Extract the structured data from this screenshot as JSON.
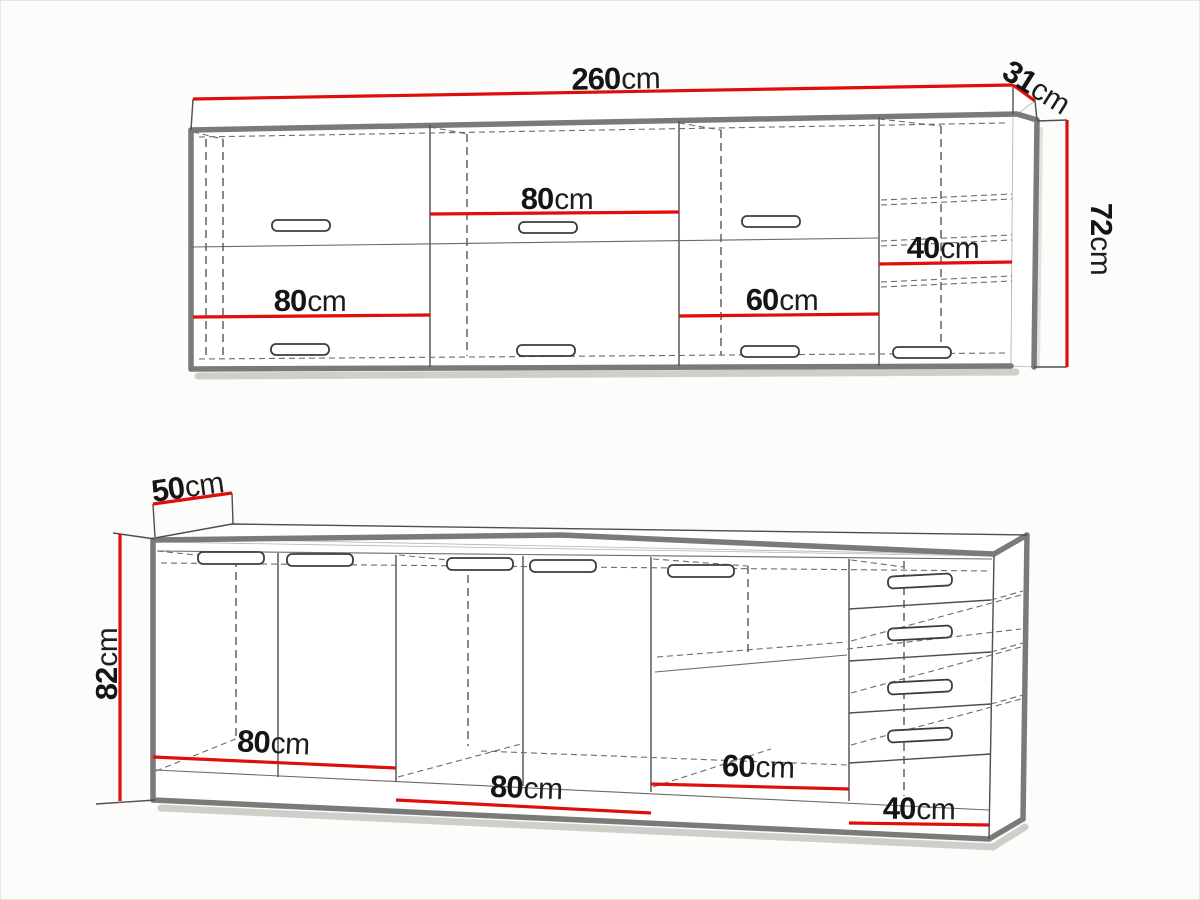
{
  "page": {
    "background": "#fcfcfa",
    "accent_red": "#e00d0d",
    "outline_gray": "#7a7a7a"
  },
  "wall_unit": {
    "name": "wall cabinet run",
    "width": {
      "value": "260",
      "unit": "cm"
    },
    "depth": {
      "value": "31",
      "unit": "cm"
    },
    "height": {
      "value": "72",
      "unit": "cm"
    },
    "sections": [
      {
        "value": "80",
        "unit": "cm"
      },
      {
        "value": "80",
        "unit": "cm"
      },
      {
        "value": "60",
        "unit": "cm"
      },
      {
        "value": "40",
        "unit": "cm"
      }
    ]
  },
  "base_unit": {
    "name": "base cabinet run",
    "depth": {
      "value": "50",
      "unit": "cm"
    },
    "height": {
      "value": "82",
      "unit": "cm"
    },
    "sections": [
      {
        "value": "80",
        "unit": "cm"
      },
      {
        "value": "80",
        "unit": "cm"
      },
      {
        "value": "60",
        "unit": "cm"
      },
      {
        "value": "40",
        "unit": "cm"
      }
    ]
  }
}
